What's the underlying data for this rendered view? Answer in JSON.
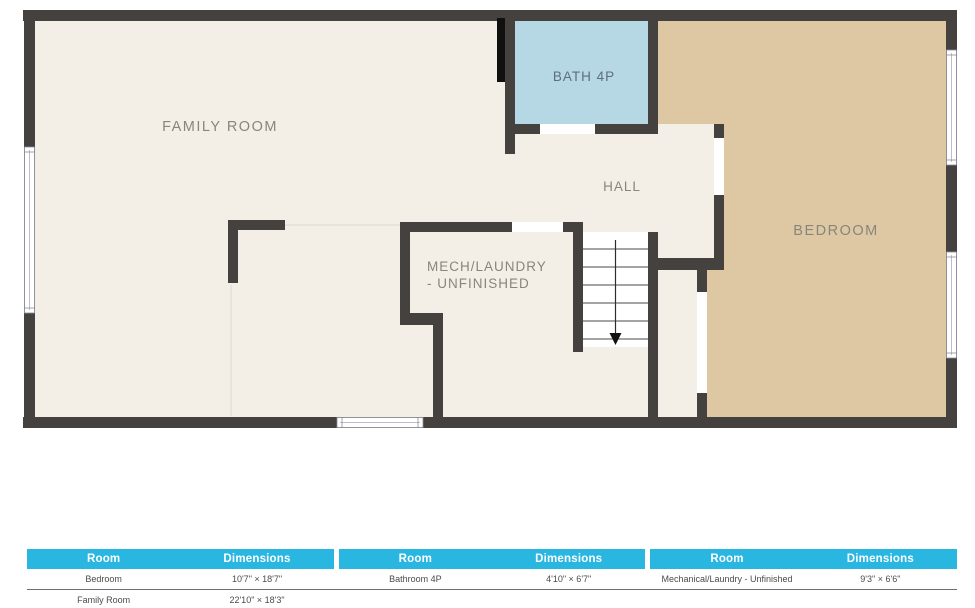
{
  "plan": {
    "rooms": {
      "family_room": {
        "label": "FAMILY ROOM"
      },
      "bath": {
        "label": "BATH 4P"
      },
      "hall": {
        "label": "HALL"
      },
      "mech_laundry": {
        "label_line1": "MECH/LAUNDRY",
        "label_line2": "- UNFINISHED"
      },
      "bedroom": {
        "label": "BEDROOM"
      }
    },
    "icons": {
      "stairs_direction": "down-arrow"
    },
    "colors": {
      "wall": "#45413e",
      "wall_accent_black": "#101010",
      "floor": "#f3efe6",
      "bedroom_floor": "#ddc8a3",
      "bath_floor": "#b6d8e5",
      "room_label": "#8a857c",
      "bath_label": "#5f6e7d"
    }
  },
  "dimensions_table": {
    "headers": [
      "Room",
      "Dimensions",
      "Room",
      "Dimensions",
      "Room",
      "Dimensions"
    ],
    "rows": [
      {
        "cells": [
          "Bedroom",
          "10'7\" × 18'7\"",
          "Bathroom 4P",
          "4'10\" × 6'7\"",
          "Mechanical/Laundry - Unfinished",
          "9'3\" × 6'6\""
        ]
      },
      {
        "cells": [
          "Family Room",
          "22'10\" × 18'3\"",
          "",
          "",
          "",
          ""
        ]
      }
    ],
    "colors": {
      "header_bg": "#29b7e2",
      "header_text": "#ffffff",
      "row_text": "#4b4b47"
    }
  }
}
